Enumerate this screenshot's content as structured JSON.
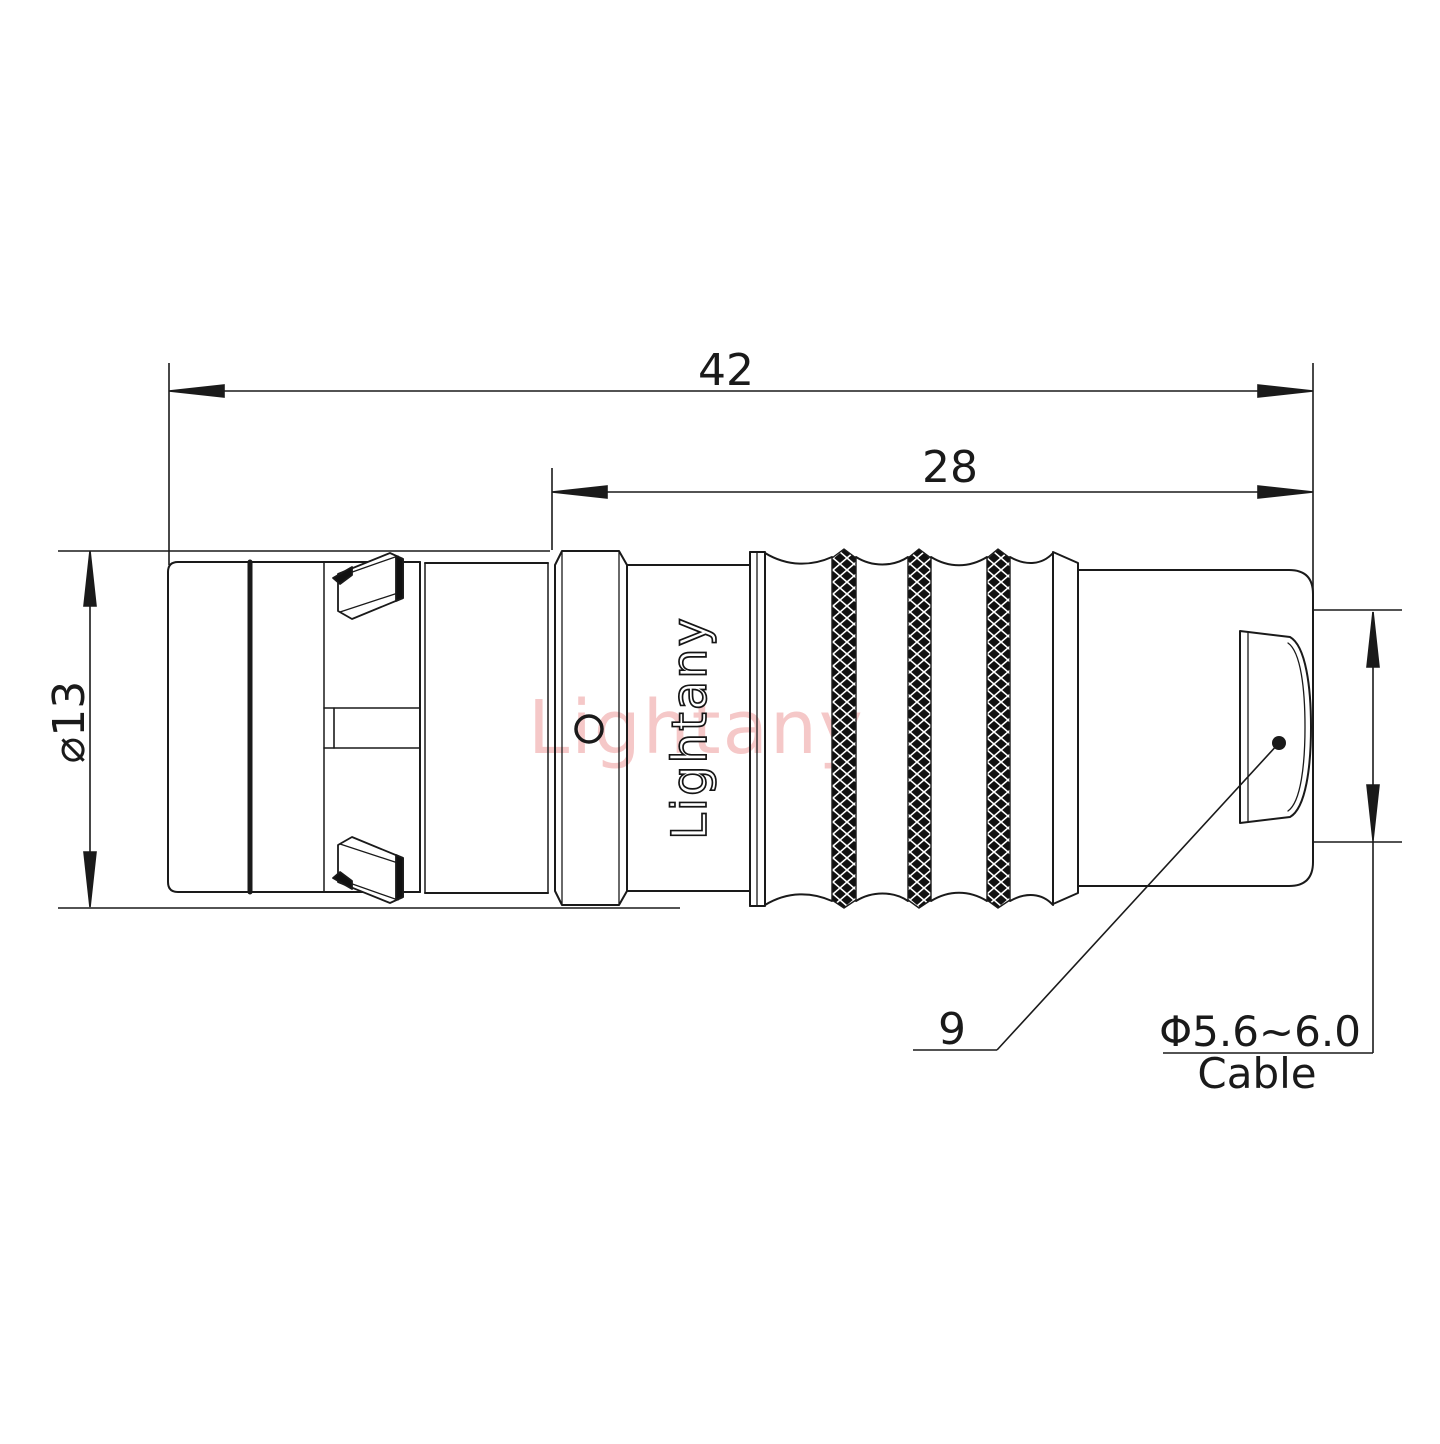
{
  "page": {
    "background": "#ffffff",
    "line_color": "#1a1a1a",
    "watermark_color": "#f2b6b6"
  },
  "drawing": {
    "type": "connector-technical-drawing",
    "dimensions": {
      "overall_length": {
        "label": "42"
      },
      "rear_length": {
        "label": "28"
      },
      "outer_diameter": {
        "label": "⌀13"
      },
      "shell_size": {
        "label": "9"
      },
      "cable_range": {
        "label": "Φ5.6~6.0",
        "caption": "Cable"
      }
    },
    "branding": {
      "watermark": "Lightany",
      "body_marking": "Lightany"
    }
  }
}
